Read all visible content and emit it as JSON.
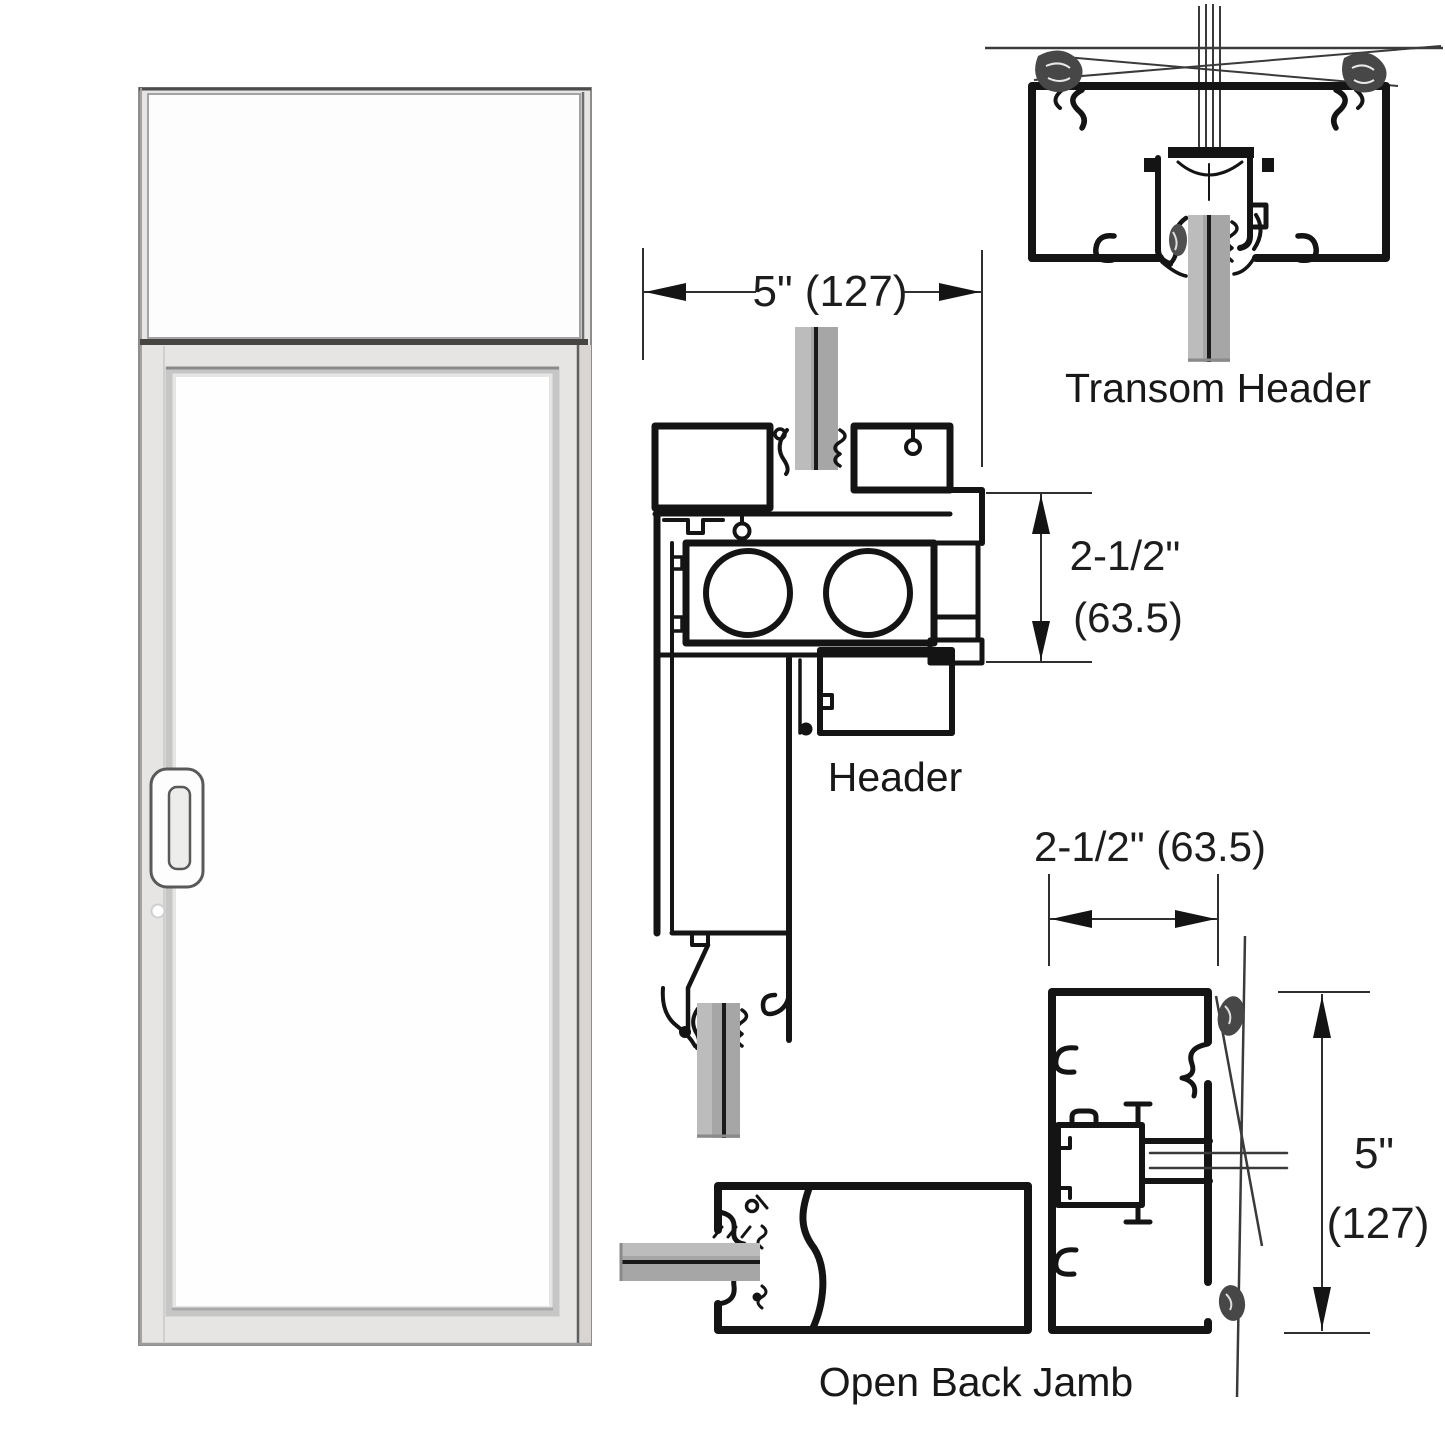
{
  "colors": {
    "ink": "#141414",
    "thin_line": "#2f2f2f",
    "glass_fill": "#a6a6a6",
    "glass_highlight": "#bcbcbc",
    "glass_center_line": "#1a1a1a",
    "door_frame_fill": "#e6e5e4",
    "door_glass_fill": "#fdfdfd",
    "anchor_blob": "#474747"
  },
  "section_labels": {
    "transom_header": "Transom Header",
    "header": "Header",
    "open_back_jamb": "Open Back Jamb"
  },
  "dimensions": {
    "header_width": "5\" (127)",
    "header_height_in": "2-1/2\"",
    "header_height_mm": "(63.5)",
    "jamb_width": "2-1/2\" (63.5)",
    "jamb_height_in": "5\"",
    "jamb_height_mm": "(127)"
  }
}
